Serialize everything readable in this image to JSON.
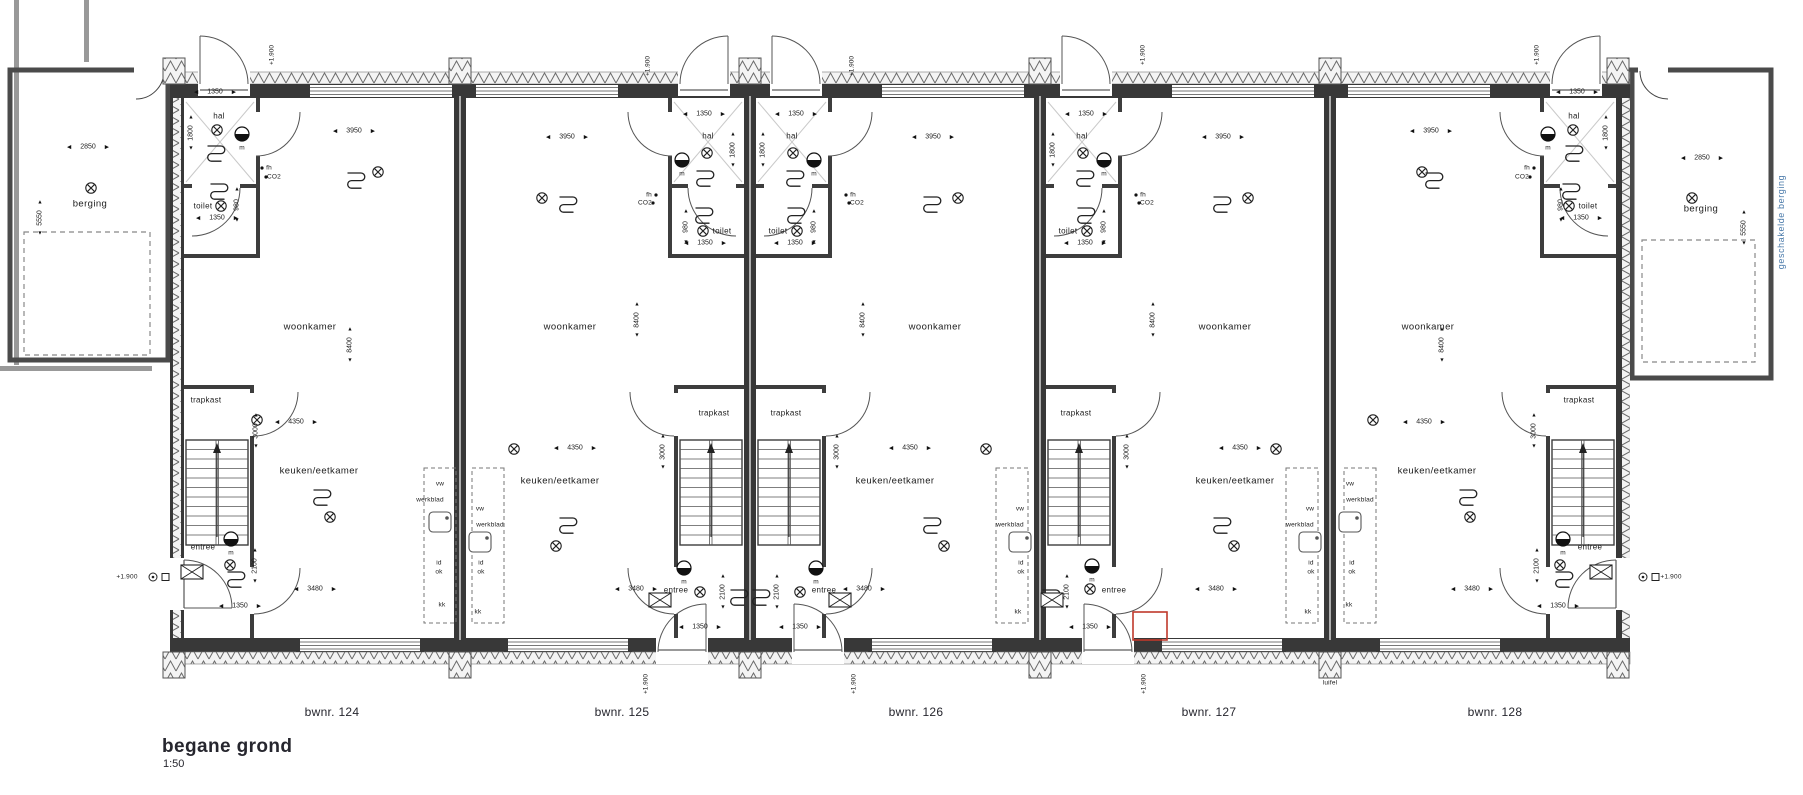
{
  "title_block": {
    "title": "begane grond",
    "scale": "1:50"
  },
  "units": [
    {
      "label": "bwnr. 124",
      "x": 332
    },
    {
      "label": "bwnr. 125",
      "x": 622
    },
    {
      "label": "bwnr. 126",
      "x": 916
    },
    {
      "label": "bwnr. 127",
      "x": 1209
    },
    {
      "label": "bwnr. 128",
      "x": 1495
    }
  ],
  "colors": {
    "wall": "#3a3a3a",
    "revision_red": "#c0392b",
    "blue_label": "#4a7aaa"
  },
  "annotations": [
    {
      "k": "room",
      "t": "woonkamer",
      "x": 310,
      "y": 327
    },
    {
      "k": "room",
      "t": "woonkamer",
      "x": 570,
      "y": 327
    },
    {
      "k": "room",
      "t": "woonkamer",
      "x": 935,
      "y": 327
    },
    {
      "k": "room",
      "t": "woonkamer",
      "x": 1225,
      "y": 327
    },
    {
      "k": "room",
      "t": "woonkamer",
      "x": 1428,
      "y": 327
    },
    {
      "k": "room",
      "t": "keuken/eetkamer",
      "x": 319,
      "y": 471
    },
    {
      "k": "room",
      "t": "keuken/eetkamer",
      "x": 560,
      "y": 481
    },
    {
      "k": "room",
      "t": "keuken/eetkamer",
      "x": 895,
      "y": 481
    },
    {
      "k": "room",
      "t": "keuken/eetkamer",
      "x": 1235,
      "y": 481
    },
    {
      "k": "room",
      "t": "keuken/eetkamer",
      "x": 1437,
      "y": 471
    },
    {
      "k": "room",
      "t": "berging",
      "x": 90,
      "y": 204
    },
    {
      "k": "room",
      "t": "berging",
      "x": 1701,
      "y": 209
    },
    {
      "k": "room-sm",
      "t": "trapkast",
      "x": 206,
      "y": 400
    },
    {
      "k": "room-sm",
      "t": "trapkast",
      "x": 714,
      "y": 413
    },
    {
      "k": "room-sm",
      "t": "trapkast",
      "x": 786,
      "y": 413
    },
    {
      "k": "room-sm",
      "t": "trapkast",
      "x": 1076,
      "y": 413
    },
    {
      "k": "room-sm",
      "t": "trapkast",
      "x": 1579,
      "y": 400
    },
    {
      "k": "room-sm",
      "t": "entree",
      "x": 203,
      "y": 547
    },
    {
      "k": "room-sm",
      "t": "entree",
      "x": 676,
      "y": 590
    },
    {
      "k": "room-sm",
      "t": "entree",
      "x": 824,
      "y": 590
    },
    {
      "k": "room-sm",
      "t": "entree",
      "x": 1114,
      "y": 590
    },
    {
      "k": "room-sm",
      "t": "entree",
      "x": 1590,
      "y": 547
    },
    {
      "k": "room-sm",
      "t": "hal",
      "x": 219,
      "y": 116
    },
    {
      "k": "room-sm",
      "t": "hal",
      "x": 708,
      "y": 136
    },
    {
      "k": "room-sm",
      "t": "hal",
      "x": 792,
      "y": 136
    },
    {
      "k": "room-sm",
      "t": "hal",
      "x": 1082,
      "y": 136
    },
    {
      "k": "room-sm",
      "t": "hal",
      "x": 1574,
      "y": 116
    },
    {
      "k": "room-sm",
      "t": "toilet",
      "x": 203,
      "y": 206
    },
    {
      "k": "room-sm",
      "t": "toilet",
      "x": 722,
      "y": 231
    },
    {
      "k": "room-sm",
      "t": "toilet",
      "x": 778,
      "y": 231
    },
    {
      "k": "room-sm",
      "t": "toilet",
      "x": 1068,
      "y": 231
    },
    {
      "k": "room-sm",
      "t": "toilet",
      "x": 1588,
      "y": 206
    },
    {
      "k": "dim",
      "t": "3950",
      "x": 354,
      "y": 131
    },
    {
      "k": "dim",
      "t": "3950",
      "x": 567,
      "y": 137
    },
    {
      "k": "dim",
      "t": "3950",
      "x": 933,
      "y": 137
    },
    {
      "k": "dim",
      "t": "3950",
      "x": 1223,
      "y": 137
    },
    {
      "k": "dim",
      "t": "3950",
      "x": 1431,
      "y": 131
    },
    {
      "k": "dim",
      "t": "4350",
      "x": 296,
      "y": 422
    },
    {
      "k": "dim",
      "t": "4350",
      "x": 575,
      "y": 448
    },
    {
      "k": "dim",
      "t": "4350",
      "x": 910,
      "y": 448
    },
    {
      "k": "dim",
      "t": "4350",
      "x": 1240,
      "y": 448
    },
    {
      "k": "dim",
      "t": "4350",
      "x": 1424,
      "y": 422
    },
    {
      "k": "dim",
      "t": "3480",
      "x": 315,
      "y": 589
    },
    {
      "k": "dim",
      "t": "3480",
      "x": 636,
      "y": 589
    },
    {
      "k": "dim",
      "t": "3480",
      "x": 864,
      "y": 589
    },
    {
      "k": "dim",
      "t": "3480",
      "x": 1216,
      "y": 589
    },
    {
      "k": "dim",
      "t": "3480",
      "x": 1472,
      "y": 589
    },
    {
      "k": "dim",
      "t": "1350",
      "x": 215,
      "y": 92
    },
    {
      "k": "dim",
      "t": "1350",
      "x": 704,
      "y": 114
    },
    {
      "k": "dim",
      "t": "1350",
      "x": 796,
      "y": 114
    },
    {
      "k": "dim",
      "t": "1350",
      "x": 1086,
      "y": 114
    },
    {
      "k": "dim",
      "t": "1350",
      "x": 1577,
      "y": 92
    },
    {
      "k": "dim",
      "t": "1350",
      "x": 217,
      "y": 218
    },
    {
      "k": "dim",
      "t": "1350",
      "x": 705,
      "y": 243
    },
    {
      "k": "dim",
      "t": "1350",
      "x": 795,
      "y": 243
    },
    {
      "k": "dim",
      "t": "1350",
      "x": 1085,
      "y": 243
    },
    {
      "k": "dim",
      "t": "1350",
      "x": 1581,
      "y": 218
    },
    {
      "k": "dim",
      "t": "1350",
      "x": 240,
      "y": 606
    },
    {
      "k": "dim",
      "t": "1350",
      "x": 700,
      "y": 627
    },
    {
      "k": "dim",
      "t": "1350",
      "x": 800,
      "y": 627
    },
    {
      "k": "dim",
      "t": "1350",
      "x": 1090,
      "y": 627
    },
    {
      "k": "dim",
      "t": "1350",
      "x": 1558,
      "y": 606
    },
    {
      "k": "dim",
      "t": "2850",
      "x": 88,
      "y": 147
    },
    {
      "k": "dim",
      "t": "2850",
      "x": 1702,
      "y": 158
    },
    {
      "k": "dimv",
      "t": "8400",
      "x": 350,
      "y": 345
    },
    {
      "k": "dimv",
      "t": "8400",
      "x": 637,
      "y": 320
    },
    {
      "k": "dimv",
      "t": "8400",
      "x": 863,
      "y": 320
    },
    {
      "k": "dimv",
      "t": "8400",
      "x": 1153,
      "y": 320
    },
    {
      "k": "dimv",
      "t": "8400",
      "x": 1442,
      "y": 345
    },
    {
      "k": "dimv",
      "t": "3000",
      "x": 256,
      "y": 431
    },
    {
      "k": "dimv",
      "t": "3000",
      "x": 663,
      "y": 452
    },
    {
      "k": "dimv",
      "t": "3000",
      "x": 837,
      "y": 452
    },
    {
      "k": "dimv",
      "t": "3000",
      "x": 1127,
      "y": 452
    },
    {
      "k": "dimv",
      "t": "3000",
      "x": 1534,
      "y": 431
    },
    {
      "k": "dimv",
      "t": "2100",
      "x": 255,
      "y": 566
    },
    {
      "k": "dimv",
      "t": "2100",
      "x": 723,
      "y": 592
    },
    {
      "k": "dimv",
      "t": "2100",
      "x": 777,
      "y": 592
    },
    {
      "k": "dimv",
      "t": "2100",
      "x": 1067,
      "y": 592
    },
    {
      "k": "dimv",
      "t": "2100",
      "x": 1537,
      "y": 566
    },
    {
      "k": "dimv",
      "t": "1800",
      "x": 191,
      "y": 133
    },
    {
      "k": "dimv",
      "t": "1800",
      "x": 733,
      "y": 150
    },
    {
      "k": "dimv",
      "t": "1800",
      "x": 763,
      "y": 150
    },
    {
      "k": "dimv",
      "t": "1800",
      "x": 1053,
      "y": 150
    },
    {
      "k": "dimv",
      "t": "1800",
      "x": 1606,
      "y": 133
    },
    {
      "k": "dimv",
      "t": "980",
      "x": 237,
      "y": 205
    },
    {
      "k": "dimv",
      "t": "980",
      "x": 686,
      "y": 227
    },
    {
      "k": "dimv",
      "t": "980",
      "x": 814,
      "y": 227
    },
    {
      "k": "dimv",
      "t": "980",
      "x": 1104,
      "y": 227
    },
    {
      "k": "dimv",
      "t": "980",
      "x": 1561,
      "y": 205
    },
    {
      "k": "dimv",
      "t": "5550",
      "x": 40,
      "y": 218
    },
    {
      "k": "dimv",
      "t": "5550",
      "x": 1744,
      "y": 228
    },
    {
      "k": "tiny",
      "t": "m",
      "x": 242,
      "y": 148
    },
    {
      "k": "tiny",
      "t": "m",
      "x": 682,
      "y": 174
    },
    {
      "k": "tiny",
      "t": "m",
      "x": 814,
      "y": 174
    },
    {
      "k": "tiny",
      "t": "m",
      "x": 1104,
      "y": 174
    },
    {
      "k": "tiny",
      "t": "m",
      "x": 1548,
      "y": 148
    },
    {
      "k": "tiny",
      "t": "m",
      "x": 231,
      "y": 553
    },
    {
      "k": "tiny",
      "t": "m",
      "x": 684,
      "y": 582
    },
    {
      "k": "tiny",
      "t": "m",
      "x": 816,
      "y": 582
    },
    {
      "k": "tiny",
      "t": "m",
      "x": 1092,
      "y": 580
    },
    {
      "k": "tiny",
      "t": "m",
      "x": 1563,
      "y": 553
    },
    {
      "k": "tiny",
      "t": "fh",
      "x": 269,
      "y": 168
    },
    {
      "k": "tiny",
      "t": "fh",
      "x": 649,
      "y": 195
    },
    {
      "k": "tiny",
      "t": "fh",
      "x": 853,
      "y": 195
    },
    {
      "k": "tiny",
      "t": "fh",
      "x": 1143,
      "y": 195
    },
    {
      "k": "tiny",
      "t": "fh",
      "x": 1527,
      "y": 168
    },
    {
      "k": "tiny",
      "t": "CO2",
      "x": 274,
      "y": 177
    },
    {
      "k": "tiny",
      "t": "CO2",
      "x": 645,
      "y": 203
    },
    {
      "k": "tiny",
      "t": "CO2",
      "x": 857,
      "y": 203
    },
    {
      "k": "tiny",
      "t": "CO2",
      "x": 1147,
      "y": 203
    },
    {
      "k": "tiny",
      "t": "CO2",
      "x": 1522,
      "y": 177
    },
    {
      "k": "tiny",
      "t": "vw",
      "x": 440,
      "y": 484
    },
    {
      "k": "tiny",
      "t": "vw",
      "x": 480,
      "y": 509
    },
    {
      "k": "tiny",
      "t": "vw",
      "x": 1020,
      "y": 509
    },
    {
      "k": "tiny",
      "t": "vw",
      "x": 1310,
      "y": 509
    },
    {
      "k": "tiny",
      "t": "vw",
      "x": 1350,
      "y": 484
    },
    {
      "k": "tiny",
      "t": "werkblad",
      "x": 430,
      "y": 500
    },
    {
      "k": "tiny",
      "t": "werkblad",
      "x": 490,
      "y": 525
    },
    {
      "k": "tiny",
      "t": "werkblad",
      "x": 1010,
      "y": 525
    },
    {
      "k": "tiny",
      "t": "werkblad",
      "x": 1300,
      "y": 525
    },
    {
      "k": "tiny",
      "t": "werkblad",
      "x": 1360,
      "y": 500
    },
    {
      "k": "tiny",
      "t": "id",
      "x": 439,
      "y": 563
    },
    {
      "k": "tiny",
      "t": "id",
      "x": 481,
      "y": 563
    },
    {
      "k": "tiny",
      "t": "id",
      "x": 1021,
      "y": 563
    },
    {
      "k": "tiny",
      "t": "id",
      "x": 1311,
      "y": 563
    },
    {
      "k": "tiny",
      "t": "id",
      "x": 1352,
      "y": 563
    },
    {
      "k": "tiny",
      "t": "ok",
      "x": 439,
      "y": 572
    },
    {
      "k": "tiny",
      "t": "ok",
      "x": 481,
      "y": 572
    },
    {
      "k": "tiny",
      "t": "ok",
      "x": 1021,
      "y": 572
    },
    {
      "k": "tiny",
      "t": "ok",
      "x": 1311,
      "y": 572
    },
    {
      "k": "tiny",
      "t": "ok",
      "x": 1352,
      "y": 572
    },
    {
      "k": "tiny",
      "t": "kk",
      "x": 442,
      "y": 605
    },
    {
      "k": "tiny",
      "t": "kk",
      "x": 478,
      "y": 612
    },
    {
      "k": "tiny",
      "t": "kk",
      "x": 1018,
      "y": 612
    },
    {
      "k": "tiny",
      "t": "kk",
      "x": 1308,
      "y": 612
    },
    {
      "k": "tiny",
      "t": "kk",
      "x": 1349,
      "y": 605
    },
    {
      "k": "tiny",
      "t": "luifel",
      "x": 1330,
      "y": 683
    },
    {
      "k": "tiny",
      "t": "+1.900",
      "x": 127,
      "y": 577
    },
    {
      "k": "tiny",
      "t": "+1.900",
      "x": 1671,
      "y": 577
    },
    {
      "k": "tinyv",
      "t": "+1.900",
      "x": 272,
      "y": 55
    },
    {
      "k": "tinyv",
      "t": "+1.900",
      "x": 648,
      "y": 66
    },
    {
      "k": "tinyv",
      "t": "+1.900",
      "x": 852,
      "y": 66
    },
    {
      "k": "tinyv",
      "t": "+1.900",
      "x": 1143,
      "y": 55
    },
    {
      "k": "tinyv",
      "t": "+1.900",
      "x": 1537,
      "y": 55
    },
    {
      "k": "tinyv",
      "t": "+1.900",
      "x": 646,
      "y": 684
    },
    {
      "k": "tinyv",
      "t": "+1.900",
      "x": 854,
      "y": 684
    },
    {
      "k": "tinyv",
      "t": "+1.900",
      "x": 1144,
      "y": 684
    },
    {
      "k": "blue",
      "t": "geschakelde berging",
      "x": 1781,
      "y": 222
    }
  ],
  "symbols": [
    {
      "t": "lamp",
      "x": 217,
      "y": 130
    },
    {
      "t": "lamp",
      "x": 707,
      "y": 153
    },
    {
      "t": "lamp",
      "x": 793,
      "y": 153
    },
    {
      "t": "lamp",
      "x": 1083,
      "y": 153
    },
    {
      "t": "lamp",
      "x": 1573,
      "y": 130
    },
    {
      "t": "lamp",
      "x": 221,
      "y": 206
    },
    {
      "t": "lamp",
      "x": 703,
      "y": 231
    },
    {
      "t": "lamp",
      "x": 797,
      "y": 231
    },
    {
      "t": "lamp",
      "x": 1087,
      "y": 231
    },
    {
      "t": "lamp",
      "x": 1569,
      "y": 206
    },
    {
      "t": "lamp",
      "x": 378,
      "y": 172
    },
    {
      "t": "lamp",
      "x": 542,
      "y": 198
    },
    {
      "t": "lamp",
      "x": 958,
      "y": 198
    },
    {
      "t": "lamp",
      "x": 1248,
      "y": 198
    },
    {
      "t": "lamp",
      "x": 1422,
      "y": 172
    },
    {
      "t": "lamp",
      "x": 257,
      "y": 420
    },
    {
      "t": "lamp",
      "x": 514,
      "y": 449
    },
    {
      "t": "lamp",
      "x": 986,
      "y": 449
    },
    {
      "t": "lamp",
      "x": 1276,
      "y": 449
    },
    {
      "t": "lamp",
      "x": 1373,
      "y": 420
    },
    {
      "t": "lamp",
      "x": 330,
      "y": 517
    },
    {
      "t": "lamp",
      "x": 556,
      "y": 546
    },
    {
      "t": "lamp",
      "x": 944,
      "y": 546
    },
    {
      "t": "lamp",
      "x": 1234,
      "y": 546
    },
    {
      "t": "lamp",
      "x": 1470,
      "y": 517
    },
    {
      "t": "lamp",
      "x": 230,
      "y": 565
    },
    {
      "t": "lamp",
      "x": 700,
      "y": 592
    },
    {
      "t": "lamp",
      "x": 800,
      "y": 592
    },
    {
      "t": "lamp",
      "x": 1090,
      "y": 589
    },
    {
      "t": "lamp",
      "x": 1560,
      "y": 565
    },
    {
      "t": "lamp",
      "x": 91,
      "y": 188
    },
    {
      "t": "lamp",
      "x": 1692,
      "y": 198
    },
    {
      "t": "meter",
      "x": 242,
      "y": 134
    },
    {
      "t": "meter",
      "x": 682,
      "y": 160
    },
    {
      "t": "meter",
      "x": 814,
      "y": 160
    },
    {
      "t": "meter",
      "x": 1104,
      "y": 160
    },
    {
      "t": "meter",
      "x": 1548,
      "y": 134
    },
    {
      "t": "meter",
      "x": 231,
      "y": 539
    },
    {
      "t": "meter",
      "x": 684,
      "y": 568
    },
    {
      "t": "meter",
      "x": 816,
      "y": 568
    },
    {
      "t": "meter",
      "x": 1092,
      "y": 566
    },
    {
      "t": "meter",
      "x": 1563,
      "y": 539
    },
    {
      "t": "radiator",
      "x": 216,
      "y": 154
    },
    {
      "t": "radiator",
      "x": 705,
      "y": 179
    },
    {
      "t": "radiator",
      "x": 795,
      "y": 179
    },
    {
      "t": "radiator",
      "x": 1085,
      "y": 179
    },
    {
      "t": "radiator",
      "x": 1574,
      "y": 154
    },
    {
      "t": "radiator",
      "x": 219,
      "y": 192
    },
    {
      "t": "radiator",
      "x": 704,
      "y": 216
    },
    {
      "t": "radiator",
      "x": 796,
      "y": 216
    },
    {
      "t": "radiator",
      "x": 1086,
      "y": 216
    },
    {
      "t": "radiator",
      "x": 1571,
      "y": 192
    },
    {
      "t": "radiator",
      "x": 356,
      "y": 181
    },
    {
      "t": "radiator",
      "x": 568,
      "y": 205
    },
    {
      "t": "radiator",
      "x": 932,
      "y": 205
    },
    {
      "t": "radiator",
      "x": 1222,
      "y": 205
    },
    {
      "t": "radiator",
      "x": 1434,
      "y": 181
    },
    {
      "t": "radiator",
      "x": 322,
      "y": 498
    },
    {
      "t": "radiator",
      "x": 568,
      "y": 526
    },
    {
      "t": "radiator",
      "x": 932,
      "y": 526
    },
    {
      "t": "radiator",
      "x": 1222,
      "y": 526
    },
    {
      "t": "radiator",
      "x": 1468,
      "y": 498
    },
    {
      "t": "radiator",
      "x": 236,
      "y": 580
    },
    {
      "t": "radiator",
      "x": 739,
      "y": 598
    },
    {
      "t": "radiator",
      "x": 761,
      "y": 598
    },
    {
      "t": "radiator",
      "x": 1051,
      "y": 598
    },
    {
      "t": "radiator",
      "x": 1564,
      "y": 580
    },
    {
      "t": "xbox",
      "x": 192,
      "y": 572
    },
    {
      "t": "xbox",
      "x": 660,
      "y": 600
    },
    {
      "t": "xbox",
      "x": 840,
      "y": 600
    },
    {
      "t": "xbox",
      "x": 1052,
      "y": 600
    },
    {
      "t": "xbox",
      "x": 1601,
      "y": 572
    },
    {
      "t": "level",
      "x": 153,
      "y": 577
    },
    {
      "t": "level",
      "x": 1643,
      "y": 577
    },
    {
      "t": "sink",
      "x": 440,
      "y": 522
    },
    {
      "t": "sink",
      "x": 480,
      "y": 542
    },
    {
      "t": "sink",
      "x": 1020,
      "y": 542
    },
    {
      "t": "sink",
      "x": 1310,
      "y": 542
    },
    {
      "t": "sink",
      "x": 1350,
      "y": 522
    },
    {
      "t": "dot",
      "x": 262,
      "y": 168
    },
    {
      "t": "dot",
      "x": 266,
      "y": 177
    },
    {
      "t": "dot",
      "x": 656,
      "y": 195
    },
    {
      "t": "dot",
      "x": 653,
      "y": 203
    },
    {
      "t": "dot",
      "x": 846,
      "y": 195
    },
    {
      "t": "dot",
      "x": 849,
      "y": 203
    },
    {
      "t": "dot",
      "x": 1136,
      "y": 195
    },
    {
      "t": "dot",
      "x": 1139,
      "y": 203
    },
    {
      "t": "dot",
      "x": 1534,
      "y": 168
    },
    {
      "t": "dot",
      "x": 1530,
      "y": 177
    }
  ]
}
